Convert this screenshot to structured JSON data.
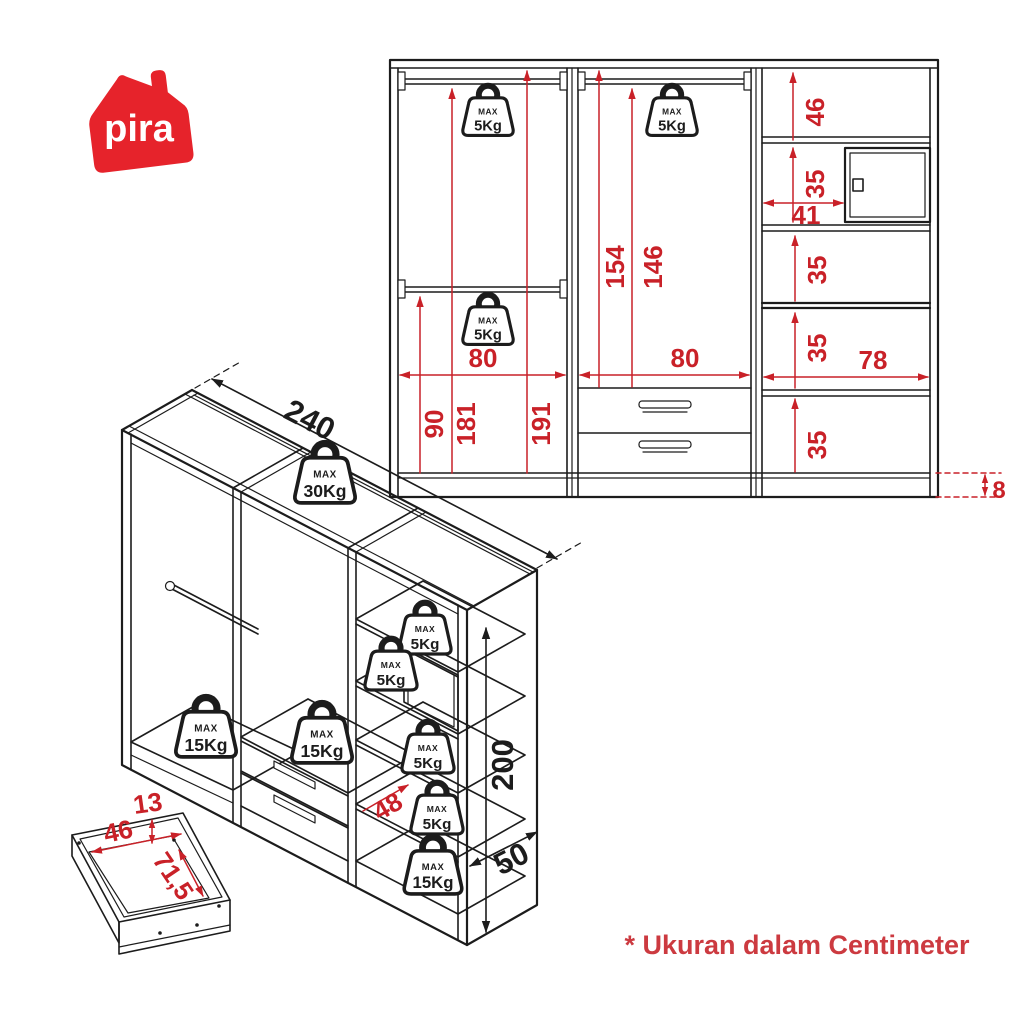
{
  "logo": {
    "text": "pira",
    "color": "#e6232b"
  },
  "note": "* Ukuran dalam Centimeter",
  "colors": {
    "line": "#1c1c1c",
    "dim_red": "#c92128",
    "note_red": "#cc3a40",
    "logo_red": "#e6232b"
  },
  "front_view": {
    "weights": [
      {
        "max": "MAX",
        "kg": "5Kg"
      },
      {
        "max": "MAX",
        "kg": "5Kg"
      },
      {
        "max": "MAX",
        "kg": "5Kg"
      }
    ],
    "dims": {
      "left_width": "80",
      "mid_width": "80",
      "right_width": "78",
      "h_lower_rail": "90",
      "h_upper_rail": "181",
      "h_top": "191",
      "h_mid_top": "154",
      "h_mid_rail": "146",
      "shelf_top": "46",
      "shelf_2": "35",
      "niche_width": "41",
      "shelf_3": "35",
      "shelf_4": "35",
      "shelf_5": "35",
      "plinth": "8"
    }
  },
  "iso_view": {
    "dims": {
      "width": "240",
      "height": "200",
      "depth": "50",
      "shelf_depth": "48"
    },
    "weights": [
      {
        "max": "MAX",
        "kg": "30Kg"
      },
      {
        "max": "MAX",
        "kg": "15Kg"
      },
      {
        "max": "MAX",
        "kg": "15Kg"
      },
      {
        "max": "MAX",
        "kg": "5Kg"
      },
      {
        "max": "MAX",
        "kg": "5Kg"
      },
      {
        "max": "MAX",
        "kg": "5Kg"
      },
      {
        "max": "MAX",
        "kg": "5Kg"
      },
      {
        "max": "MAX",
        "kg": "15Kg"
      }
    ]
  },
  "drawer_detail": {
    "dims": {
      "height": "13",
      "width": "46",
      "depth": "71,5"
    }
  }
}
